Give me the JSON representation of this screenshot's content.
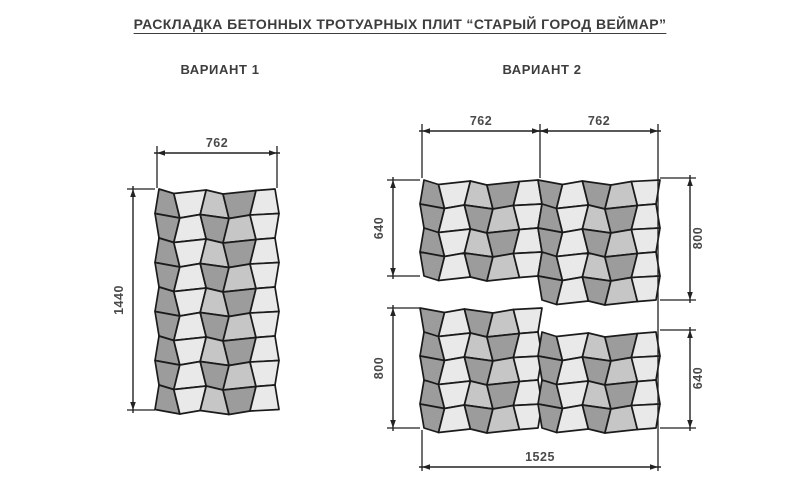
{
  "title": "РАСКЛАДКА БЕТОННЫХ ТРОТУАРНЫХ ПЛИТ “СТАРЫЙ ГОРОД ВЕЙМАР”",
  "variant1": {
    "label": "ВАРИАНТ  1"
  },
  "variant2": {
    "label": "ВАРИАНТ  2"
  },
  "palette": {
    "shades": [
      "#9c9c9c",
      "#e9e9e9",
      "#c6c6c6"
    ],
    "outline": "#1b1b1b",
    "dim_color": "#222222",
    "dim_text_color": "#4a4a4a",
    "background": "#ffffff"
  },
  "pattern": {
    "cols": [
      0,
      0.165,
      0.385,
      0.575,
      0.8,
      1
    ],
    "zigzag": [
      0,
      4.5,
      1,
      5,
      1.5,
      0
    ],
    "slant": 3,
    "edge_slant": 2,
    "even_row_shades": [
      0,
      1,
      2,
      0,
      1
    ],
    "odd_row_shades": [
      0,
      1,
      0,
      2,
      1
    ]
  },
  "canvas": {
    "width": 800,
    "height": 496
  },
  "panels": [
    {
      "name": "variant1-panel",
      "x": 157,
      "y": 189,
      "w": 120,
      "rows": 9,
      "rowH": 24.5,
      "phase": 0
    },
    {
      "name": "variant2-blockA-left",
      "x": 422,
      "y": 180,
      "w": 118,
      "rows": 4,
      "rowH": 24,
      "phase": 0
    },
    {
      "name": "variant2-blockA-right",
      "x": 540,
      "y": 180,
      "w": 118,
      "rows": 5,
      "rowH": 24,
      "phase": 1
    },
    {
      "name": "variant2-blockB-left",
      "x": 422,
      "y": 308,
      "w": 118,
      "rows": 5,
      "rowH": 24,
      "phase": 1
    },
    {
      "name": "variant2-blockB-right",
      "x": 540,
      "y": 332,
      "w": 118,
      "rows": 4,
      "rowH": 24,
      "phase": 0
    }
  ],
  "dims": [
    {
      "o": "h",
      "x1": 157,
      "x2": 277,
      "y": 153,
      "label": "762",
      "lx": 217,
      "ly": 147
    },
    {
      "o": "v",
      "x": 133,
      "y1": 189,
      "y2": 410,
      "label": "1440",
      "lx": 123,
      "ly": 300
    },
    {
      "o": "h",
      "x1": 422,
      "x2": 540,
      "y": 131,
      "label": "762",
      "lx": 481,
      "ly": 125
    },
    {
      "o": "h",
      "x1": 540,
      "x2": 658,
      "y": 131,
      "label": "762",
      "lx": 599,
      "ly": 125
    },
    {
      "o": "v",
      "x": 393,
      "y1": 180,
      "y2": 276,
      "label": "640",
      "lx": 383,
      "ly": 228
    },
    {
      "o": "v",
      "x": 690,
      "y1": 178,
      "y2": 300,
      "label": "800",
      "lx": 702,
      "ly": 238
    },
    {
      "o": "v",
      "x": 393,
      "y1": 308,
      "y2": 428,
      "label": "800",
      "lx": 383,
      "ly": 368
    },
    {
      "o": "v",
      "x": 690,
      "y1": 330,
      "y2": 428,
      "label": "640",
      "lx": 702,
      "ly": 378
    },
    {
      "o": "h",
      "x1": 422,
      "x2": 658,
      "y": 467,
      "label": "1525",
      "lx": 540,
      "ly": 461
    }
  ],
  "ext_lines": [
    {
      "x1": 157,
      "y1": 146,
      "x2": 157,
      "y2": 188
    },
    {
      "x1": 277,
      "y1": 146,
      "x2": 277,
      "y2": 188
    },
    {
      "x1": 127,
      "y1": 189,
      "x2": 155,
      "y2": 189
    },
    {
      "x1": 127,
      "y1": 410,
      "x2": 155,
      "y2": 410
    },
    {
      "x1": 422,
      "y1": 124,
      "x2": 422,
      "y2": 178
    },
    {
      "x1": 540,
      "y1": 124,
      "x2": 540,
      "y2": 178
    },
    {
      "x1": 658,
      "y1": 124,
      "x2": 658,
      "y2": 471
    },
    {
      "x1": 422,
      "y1": 430,
      "x2": 422,
      "y2": 471
    },
    {
      "x1": 387,
      "y1": 180,
      "x2": 420,
      "y2": 180
    },
    {
      "x1": 387,
      "y1": 276,
      "x2": 420,
      "y2": 276
    },
    {
      "x1": 387,
      "y1": 308,
      "x2": 420,
      "y2": 308
    },
    {
      "x1": 387,
      "y1": 428,
      "x2": 420,
      "y2": 428
    },
    {
      "x1": 660,
      "y1": 178,
      "x2": 696,
      "y2": 178
    },
    {
      "x1": 660,
      "y1": 300,
      "x2": 696,
      "y2": 300
    },
    {
      "x1": 660,
      "y1": 330,
      "x2": 696,
      "y2": 330
    },
    {
      "x1": 660,
      "y1": 428,
      "x2": 696,
      "y2": 428
    }
  ]
}
